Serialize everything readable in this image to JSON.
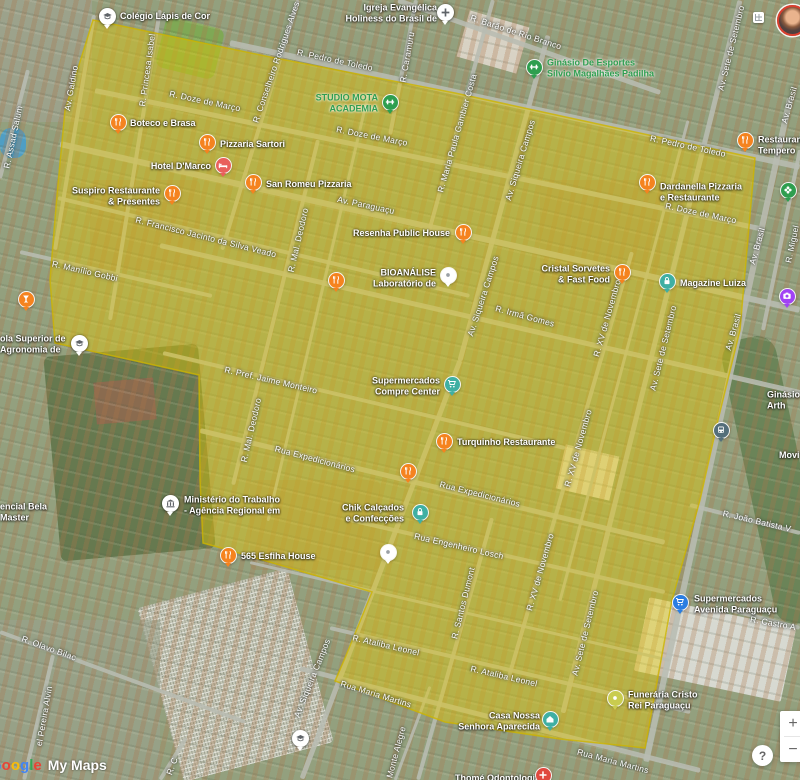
{
  "app": {
    "watermark_google_letters": [
      {
        "ch": "G",
        "color": "#4285F4"
      },
      {
        "ch": "o",
        "color": "#EA4335"
      },
      {
        "ch": "o",
        "color": "#FBBC05"
      },
      {
        "ch": "g",
        "color": "#4285F4"
      },
      {
        "ch": "l",
        "color": "#34A853"
      },
      {
        "ch": "e",
        "color": "#EA4335"
      }
    ],
    "watermark_mymaps": "My Maps",
    "zoom_in": "+",
    "zoom_out": "−",
    "help": "?"
  },
  "map": {
    "highlight": {
      "fill": "#E8CB00",
      "fill_opacity": 0.42,
      "stroke": "#CDB400",
      "stroke_opacity": 0.8,
      "points": "93,20 270,57 455,93 755,158 740,330 718,420 700,500 672,600 645,748 560,739 445,722 335,681 345,658 372,592 225,549 203,543 200,480 199,375 55,343 50,280 57,195 65,110"
    },
    "roads": [
      {
        "x1": 398,
        "y1": 0,
        "x2": 660,
        "y2": 92,
        "w": 5
      },
      {
        "x1": 230,
        "y1": 43,
        "x2": 800,
        "y2": 167,
        "w": 6
      },
      {
        "x1": 95,
        "y1": 90,
        "x2": 760,
        "y2": 228,
        "w": 5
      },
      {
        "x1": 60,
        "y1": 144,
        "x2": 800,
        "y2": 310,
        "w": 6
      },
      {
        "x1": 58,
        "y1": 198,
        "x2": 470,
        "y2": 296,
        "w": 4
      },
      {
        "x1": 20,
        "y1": 252,
        "x2": 212,
        "y2": 296,
        "w": 4
      },
      {
        "x1": 160,
        "y1": 245,
        "x2": 800,
        "y2": 392,
        "w": 5
      },
      {
        "x1": 163,
        "y1": 353,
        "x2": 565,
        "y2": 448,
        "w": 4
      },
      {
        "x1": 200,
        "y1": 430,
        "x2": 665,
        "y2": 542,
        "w": 5
      },
      {
        "x1": 350,
        "y1": 520,
        "x2": 665,
        "y2": 592,
        "w": 4
      },
      {
        "x1": 250,
        "y1": 562,
        "x2": 670,
        "y2": 660,
        "w": 3
      },
      {
        "x1": 330,
        "y1": 628,
        "x2": 690,
        "y2": 712,
        "w": 4
      },
      {
        "x1": 300,
        "y1": 668,
        "x2": 700,
        "y2": 770,
        "w": 5
      },
      {
        "x1": 0,
        "y1": 632,
        "x2": 245,
        "y2": 722,
        "w": 4
      },
      {
        "x1": 690,
        "y1": 505,
        "x2": 800,
        "y2": 533,
        "w": 4
      },
      {
        "x1": 730,
        "y1": 610,
        "x2": 800,
        "y2": 628,
        "w": 4
      },
      {
        "x1": 94,
        "y1": 15,
        "x2": 55,
        "y2": 250,
        "w": 4
      },
      {
        "x1": 28,
        "y1": 70,
        "x2": 0,
        "y2": 178,
        "w": 4
      },
      {
        "x1": 160,
        "y1": 10,
        "x2": 110,
        "y2": 320,
        "w": 4
      },
      {
        "x1": 298,
        "y1": 0,
        "x2": 222,
        "y2": 250,
        "w": 4
      },
      {
        "x1": 416,
        "y1": 0,
        "x2": 390,
        "y2": 135,
        "w": 4
      },
      {
        "x1": 493,
        "y1": 0,
        "x2": 428,
        "y2": 235,
        "w": 4
      },
      {
        "x1": 548,
        "y1": 35,
        "x2": 460,
        "y2": 360,
        "w": 5
      },
      {
        "x1": 460,
        "y1": 360,
        "x2": 302,
        "y2": 778,
        "w": 5
      },
      {
        "x1": 318,
        "y1": 140,
        "x2": 233,
        "y2": 485,
        "w": 4
      },
      {
        "x1": 368,
        "y1": 95,
        "x2": 268,
        "y2": 520,
        "w": 3
      },
      {
        "x1": 632,
        "y1": 252,
        "x2": 508,
        "y2": 680,
        "w": 4
      },
      {
        "x1": 688,
        "y1": 120,
        "x2": 560,
        "y2": 600,
        "w": 3
      },
      {
        "x1": 740,
        "y1": 0,
        "x2": 563,
        "y2": 712,
        "w": 5
      },
      {
        "x1": 790,
        "y1": 98,
        "x2": 646,
        "y2": 762,
        "w": 6
      },
      {
        "x1": 800,
        "y1": 150,
        "x2": 763,
        "y2": 330,
        "w": 4
      },
      {
        "x1": 492,
        "y1": 518,
        "x2": 418,
        "y2": 780,
        "w": 4
      },
      {
        "x1": 430,
        "y1": 686,
        "x2": 395,
        "y2": 780,
        "w": 3
      },
      {
        "x1": 53,
        "y1": 655,
        "x2": 24,
        "y2": 780,
        "w": 4
      },
      {
        "x1": 186,
        "y1": 738,
        "x2": 160,
        "y2": 780,
        "w": 4
      }
    ],
    "street_labels": [
      {
        "t": "R. Assad Salum",
        "x": 13,
        "y": 137,
        "r": -78
      },
      {
        "t": "Av. Galdino",
        "x": 71,
        "y": 88,
        "r": -80
      },
      {
        "t": "R. Princesa Isabel",
        "x": 147,
        "y": 70,
        "r": -82
      },
      {
        "t": "R. Conselheiro Rodrigues Alves",
        "x": 276,
        "y": 62,
        "r": -71
      },
      {
        "t": "R. Caramuru",
        "x": 407,
        "y": 57,
        "r": -80
      },
      {
        "t": "R. Maria Paula Gambier Costa",
        "x": 457,
        "y": 133,
        "r": -74
      },
      {
        "t": "Av. Siqueira Campos",
        "x": 520,
        "y": 160,
        "r": -73
      },
      {
        "t": "Av. Siqueira Campos",
        "x": 483,
        "y": 296,
        "r": -72
      },
      {
        "t": "Av. Siqueira Campos",
        "x": 312,
        "y": 678,
        "r": -68
      },
      {
        "t": "R. Mal. Deodoro",
        "x": 298,
        "y": 240,
        "r": -77
      },
      {
        "t": "R. Mal. Deodoro",
        "x": 251,
        "y": 430,
        "r": -77
      },
      {
        "t": "R. XV de Novembro",
        "x": 607,
        "y": 318,
        "r": -74
      },
      {
        "t": "R. XV de Novembro",
        "x": 578,
        "y": 448,
        "r": -74
      },
      {
        "t": "R. XV de Novembro",
        "x": 540,
        "y": 572,
        "r": -74
      },
      {
        "t": "Av. Sete de Setembro",
        "x": 731,
        "y": 48,
        "r": -76
      },
      {
        "t": "Av. Sete de Setembro",
        "x": 663,
        "y": 348,
        "r": -76
      },
      {
        "t": "Av. Sete de Setembro",
        "x": 585,
        "y": 633,
        "r": -76
      },
      {
        "t": "Av. Brasil",
        "x": 789,
        "y": 105,
        "r": -74
      },
      {
        "t": "Av. Brasil",
        "x": 757,
        "y": 246,
        "r": -74
      },
      {
        "t": "Av. Brasil",
        "x": 733,
        "y": 332,
        "r": -74
      },
      {
        "t": "R. Miguel",
        "x": 792,
        "y": 244,
        "r": -78
      },
      {
        "t": "R. Santos Dumont",
        "x": 463,
        "y": 603,
        "r": -76
      },
      {
        "t": "Monte Alegre",
        "x": 396,
        "y": 752,
        "r": -75
      },
      {
        "t": "el Pereira Alvin",
        "x": 44,
        "y": 716,
        "r": -80
      },
      {
        "t": "R. C",
        "x": 172,
        "y": 766,
        "r": -70
      },
      {
        "t": "R. Barão de Rio Branco",
        "x": 516,
        "y": 32,
        "r": 18
      },
      {
        "t": "R. Pedro de Toledo",
        "x": 335,
        "y": 60,
        "r": 12
      },
      {
        "t": "R. Pedro de Toledo",
        "x": 688,
        "y": 146,
        "r": 12
      },
      {
        "t": "R. Doze de Março",
        "x": 205,
        "y": 101,
        "r": 12
      },
      {
        "t": "R. Doze de Março",
        "x": 372,
        "y": 136,
        "r": 11
      },
      {
        "t": "R. Doze de Março",
        "x": 701,
        "y": 213,
        "r": 12
      },
      {
        "t": "Av. Paraguaçu",
        "x": 366,
        "y": 205,
        "r": 12
      },
      {
        "t": "R. Francisco Jacinto da Silva Veado",
        "x": 206,
        "y": 237,
        "r": 14
      },
      {
        "t": "R. Manílio Gobbi",
        "x": 85,
        "y": 271,
        "r": 13
      },
      {
        "t": "R. Irmã Gomes",
        "x": 525,
        "y": 316,
        "r": 15
      },
      {
        "t": "R. Pref. Jaime Monteiro",
        "x": 271,
        "y": 380,
        "r": 13
      },
      {
        "t": "Rua Expedicionários",
        "x": 315,
        "y": 459,
        "r": 15
      },
      {
        "t": "Rua Expedicionários",
        "x": 480,
        "y": 494,
        "r": 14
      },
      {
        "t": "Rua Engenheiro Losch",
        "x": 459,
        "y": 546,
        "r": 13
      },
      {
        "t": "R. Ataliba Leonel",
        "x": 386,
        "y": 645,
        "r": 13
      },
      {
        "t": "R. Ataliba Leonel",
        "x": 504,
        "y": 676,
        "r": 13
      },
      {
        "t": "Rua Maria Martins",
        "x": 376,
        "y": 694,
        "r": 17
      },
      {
        "t": "Rua Maria Martins",
        "x": 613,
        "y": 761,
        "r": 15
      },
      {
        "t": "R. João Batista V",
        "x": 757,
        "y": 521,
        "r": 13
      },
      {
        "t": "R. Castro A",
        "x": 773,
        "y": 623,
        "r": 10
      },
      {
        "t": "R. Olavo Bilac",
        "x": 49,
        "y": 648,
        "r": 20
      }
    ],
    "poi_labels": [
      {
        "lines": [
          "Colégio Lápis de Cor"
        ],
        "x": 120,
        "y": 16,
        "a": "l",
        "c": "w"
      },
      {
        "lines": [
          "Igreja Evangélica",
          "Holiness do Brasil de"
        ],
        "x": 437,
        "y": 13,
        "a": "r",
        "c": "w"
      },
      {
        "lines": [
          "Ginásio De Esportes",
          "Sílvio Magalhães Padilha"
        ],
        "x": 547,
        "y": 68,
        "a": "l",
        "c": "g"
      },
      {
        "lines": [
          "STUDIO MOTA",
          "ACADEMIA"
        ],
        "x": 378,
        "y": 103,
        "a": "r",
        "c": "g"
      },
      {
        "lines": [
          "Boteco e Brasa"
        ],
        "x": 130,
        "y": 123,
        "a": "l",
        "c": "w"
      },
      {
        "lines": [
          "Pizzaria Sartori"
        ],
        "x": 220,
        "y": 144,
        "a": "l",
        "c": "w"
      },
      {
        "lines": [
          "Hotel D'Marco"
        ],
        "x": 211,
        "y": 166,
        "a": "r",
        "c": "w"
      },
      {
        "lines": [
          "San Romeu Pizzaria"
        ],
        "x": 266,
        "y": 184,
        "a": "l",
        "c": "w"
      },
      {
        "lines": [
          "Suspiro Restaurante",
          "& Presentes"
        ],
        "x": 160,
        "y": 196,
        "a": "r",
        "c": "w"
      },
      {
        "lines": [
          "Dardanella Pizzaria",
          "e Restaurante"
        ],
        "x": 660,
        "y": 192,
        "a": "l",
        "c": "w"
      },
      {
        "lines": [
          "Restaurante",
          "Tempero"
        ],
        "x": 758,
        "y": 145,
        "a": "l",
        "c": "w"
      },
      {
        "lines": [
          "Resenha Public House"
        ],
        "x": 450,
        "y": 233,
        "a": "r",
        "c": "w"
      },
      {
        "lines": [
          "BIOANÁLISE",
          "Laboratório de"
        ],
        "x": 436,
        "y": 278,
        "a": "r",
        "c": "w"
      },
      {
        "lines": [
          "Cristal Sorvetes",
          "& Fast Food"
        ],
        "x": 610,
        "y": 274,
        "a": "r",
        "c": "w"
      },
      {
        "lines": [
          "Magazine Luiza"
        ],
        "x": 680,
        "y": 283,
        "a": "l",
        "c": "w"
      },
      {
        "lines": [
          "Supermercados",
          "Compre Center"
        ],
        "x": 440,
        "y": 386,
        "a": "r",
        "c": "w"
      },
      {
        "lines": [
          "Turquinho Restaurante"
        ],
        "x": 457,
        "y": 442,
        "a": "l",
        "c": "w"
      },
      {
        "lines": [
          "Ministério do Trabalho",
          "- Agência Regional em"
        ],
        "x": 184,
        "y": 505,
        "a": "l",
        "c": "w"
      },
      {
        "lines": [
          "565 Esfiha House"
        ],
        "x": 241,
        "y": 556,
        "a": "l",
        "c": "w"
      },
      {
        "lines": [
          "Chik Calçados",
          "e Confecções"
        ],
        "x": 404,
        "y": 513,
        "a": "r",
        "c": "w"
      },
      {
        "lines": [
          "Supermercados",
          "Avenida Paraguaçu"
        ],
        "x": 694,
        "y": 604,
        "a": "l",
        "c": "w"
      },
      {
        "lines": [
          "Funerária Cristo",
          "Rei Paraguaçu"
        ],
        "x": 628,
        "y": 700,
        "a": "l",
        "c": "w"
      },
      {
        "lines": [
          "Casa Nossa",
          "Senhora Aparecida"
        ],
        "x": 540,
        "y": 721,
        "a": "r",
        "c": "w"
      },
      {
        "lines": [
          "Thomé Odontologia"
        ],
        "x": 455,
        "y": 778,
        "a": "l",
        "c": "w"
      },
      {
        "lines": [
          "ola Superior de",
          "Agronomia de"
        ],
        "x": 0,
        "y": 344,
        "a": "l",
        "c": "w"
      },
      {
        "lines": [
          "encial Bela",
          "Master"
        ],
        "x": 0,
        "y": 512,
        "a": "l",
        "c": "w"
      },
      {
        "lines": [
          "Ginásio",
          "Arth"
        ],
        "x": 767,
        "y": 400,
        "a": "l",
        "c": "w"
      },
      {
        "lines": [
          "Movi"
        ],
        "x": 779,
        "y": 455,
        "a": "l",
        "c": "w"
      }
    ],
    "markers": [
      {
        "n": "colegio-lapis-de-cor",
        "x": 107,
        "y": 16,
        "type": "white-school"
      },
      {
        "n": "igreja-evangelica",
        "x": 445,
        "y": 12,
        "type": "white-church"
      },
      {
        "n": "ginasio-de-esportes",
        "x": 534,
        "y": 67,
        "type": "green-dumbbell"
      },
      {
        "n": "studio-mota-academia",
        "x": 390,
        "y": 102,
        "type": "green-dumbbell"
      },
      {
        "n": "boteco-e-brasa",
        "x": 118,
        "y": 122,
        "type": "restaurant"
      },
      {
        "n": "pizzaria-sartori",
        "x": 207,
        "y": 142,
        "type": "restaurant"
      },
      {
        "n": "hotel-d-marco",
        "x": 223,
        "y": 165,
        "type": "hotel"
      },
      {
        "n": "san-romeu-pizzaria",
        "x": 253,
        "y": 182,
        "type": "restaurant"
      },
      {
        "n": "suspiro-restaurante",
        "x": 172,
        "y": 193,
        "type": "restaurant"
      },
      {
        "n": "dardanella-pizzaria",
        "x": 647,
        "y": 182,
        "type": "restaurant"
      },
      {
        "n": "restaurante-tempero",
        "x": 745,
        "y": 140,
        "type": "restaurant"
      },
      {
        "n": "resenha-public-house",
        "x": 463,
        "y": 232,
        "type": "restaurant"
      },
      {
        "n": "restaurant-unlabeled-1",
        "x": 336,
        "y": 280,
        "type": "restaurant"
      },
      {
        "n": "bioanalise-laboratorio",
        "x": 448,
        "y": 275,
        "type": "white-dot"
      },
      {
        "n": "cristal-sorvetes",
        "x": 622,
        "y": 272,
        "type": "restaurant"
      },
      {
        "n": "magazine-luiza",
        "x": 667,
        "y": 281,
        "type": "teal-lock"
      },
      {
        "n": "supermercados-compre-center",
        "x": 452,
        "y": 384,
        "type": "teal-cart"
      },
      {
        "n": "turquinho-restaurante",
        "x": 444,
        "y": 441,
        "type": "restaurant"
      },
      {
        "n": "restaurant-unlabeled-2",
        "x": 408,
        "y": 471,
        "type": "restaurant"
      },
      {
        "n": "ministerio-do-trabalho",
        "x": 170,
        "y": 503,
        "type": "white-gov"
      },
      {
        "n": "esfiha-house-565",
        "x": 228,
        "y": 555,
        "type": "restaurant"
      },
      {
        "n": "chik-calcados",
        "x": 420,
        "y": 512,
        "type": "teal-lock"
      },
      {
        "n": "supermercados-avenida-paraguacu",
        "x": 680,
        "y": 602,
        "type": "blue-cart"
      },
      {
        "n": "funeraria-cristo-rei",
        "x": 615,
        "y": 698,
        "type": "olive-dot"
      },
      {
        "n": "casa-nossa-senhora-aparecida",
        "x": 550,
        "y": 719,
        "type": "teal-house"
      },
      {
        "n": "thome-odontologia",
        "x": 543,
        "y": 775,
        "type": "red-cross"
      },
      {
        "n": "school-unlabeled",
        "x": 300,
        "y": 738,
        "type": "white-school"
      },
      {
        "n": "escola-superior-agronomia",
        "x": 79,
        "y": 343,
        "type": "white-school"
      },
      {
        "n": "bar-left-edge",
        "x": 26,
        "y": 299,
        "type": "orange-bar"
      },
      {
        "n": "flower-right-edge",
        "x": 788,
        "y": 190,
        "type": "green-flower"
      },
      {
        "n": "camera-right-edge",
        "x": 787,
        "y": 296,
        "type": "purple-camera"
      },
      {
        "n": "transit-av-brasil",
        "x": 721,
        "y": 430,
        "type": "gray-bus"
      },
      {
        "n": "white-dot-2",
        "x": 388,
        "y": 552,
        "type": "white-dot"
      }
    ],
    "marker_colors": {
      "restaurant": "#F5831F",
      "hotel": "#E95F5C",
      "teal": "#3FAFA3",
      "blue": "#2A7DE1",
      "green": "#2E9E4F",
      "purple": "#A142F4",
      "olive": "#C9CC4F",
      "gray": "#546E7A",
      "red": "#E0483F",
      "white": "#FFFFFF",
      "white_icon": "#5F6368"
    }
  }
}
